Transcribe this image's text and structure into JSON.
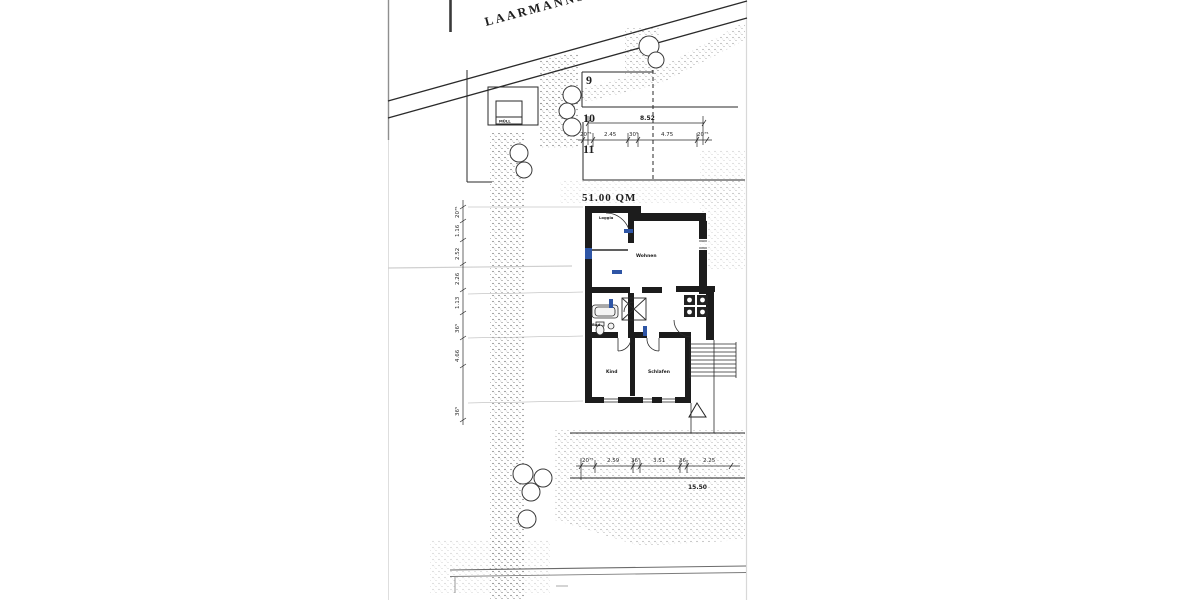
{
  "street": {
    "name": "LAARMANNSTR."
  },
  "plots": {
    "p9": "9",
    "p10": "10",
    "p11": "11"
  },
  "site": {
    "muell_label": "MÜLL",
    "area_label": "51.00 QM"
  },
  "rooms": {
    "loggia": "Loggia",
    "wohnen": "Wohnen",
    "bad": "Bad",
    "kind": "Kind",
    "schlafen": "Schlafen"
  },
  "dims": {
    "top_total": "8.52",
    "top_chain": [
      "20⁷⁵",
      "2.45",
      "30⁵",
      "4.75",
      "20⁷⁵"
    ],
    "left_chain": [
      "20⁷⁵",
      "1.16",
      "2.52",
      "2.26",
      "1.13",
      "36⁵",
      "4.66",
      "36⁵"
    ],
    "bottom_chain": [
      "20⁷⁵",
      "2.59",
      "36⁵",
      "3.51",
      "36",
      "2.25"
    ],
    "bottom_total": "15.50"
  },
  "colors": {
    "ink": "#1f1f1f",
    "window_blue": "#2e55a5",
    "paper": "#ffffff"
  }
}
